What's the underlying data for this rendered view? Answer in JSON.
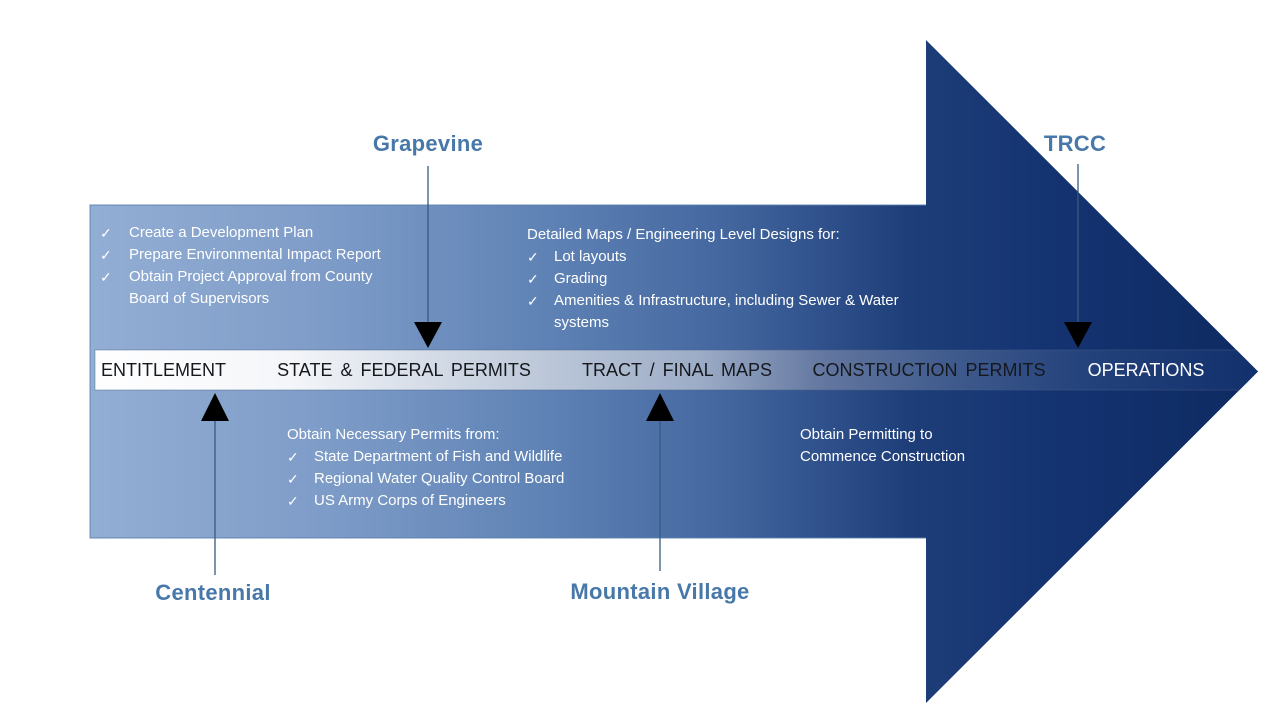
{
  "diagram_title": "Land development process flow arrow",
  "icons": {
    "check": "✓"
  },
  "colors": {
    "body_gradient_light": "#93aed4",
    "body_gradient_dark": "#0e2a61",
    "band_left": "#ffffff",
    "band_mid": "#9dadc7",
    "band_right": "#12306b",
    "project_label_blue": "#4878a9",
    "stage_text_dark": "#15181d",
    "stage_text_operations": "#ffffff",
    "connector_line": "#355a80",
    "connector_marker": "#000000",
    "panel_text": "#ffffff"
  },
  "timeline": {
    "stages": [
      {
        "label": "ENTITLEMENT"
      },
      {
        "label": "STATE & FEDERAL PERMITS"
      },
      {
        "label": "TRACT / FINAL MAPS"
      },
      {
        "label": "CONSTRUCTION PERMITS"
      },
      {
        "label": "OPERATIONS"
      }
    ]
  },
  "projects": {
    "grapevine": {
      "name": "Grapevine",
      "points_to_stage": "STATE & FEDERAL PERMITS"
    },
    "trcc": {
      "name": "TRCC",
      "points_to_stage": "OPERATIONS"
    },
    "centennial": {
      "name": "Centennial",
      "points_to_stage": "ENTITLEMENT"
    },
    "mountain_village": {
      "name": "Mountain Village",
      "points_to_stage": "TRACT / FINAL MAPS"
    }
  },
  "panels": {
    "entitlement": {
      "items": [
        "Create a Development Plan",
        "Prepare Environmental Impact Report",
        "Obtain Project Approval from County Board of Supervisors"
      ]
    },
    "detailed_maps": {
      "heading": "Detailed Maps / Engineering Level Designs for:",
      "items": [
        "Lot layouts",
        "Grading",
        "Amenities & Infrastructure, including Sewer & Water systems"
      ]
    },
    "permits": {
      "heading": "Obtain Necessary Permits from:",
      "items": [
        "State Department of Fish and Wildlife",
        "Regional Water Quality Control Board",
        "US Army Corps of Engineers"
      ]
    },
    "construction": {
      "text": "Obtain Permitting to Commence Construction"
    }
  }
}
